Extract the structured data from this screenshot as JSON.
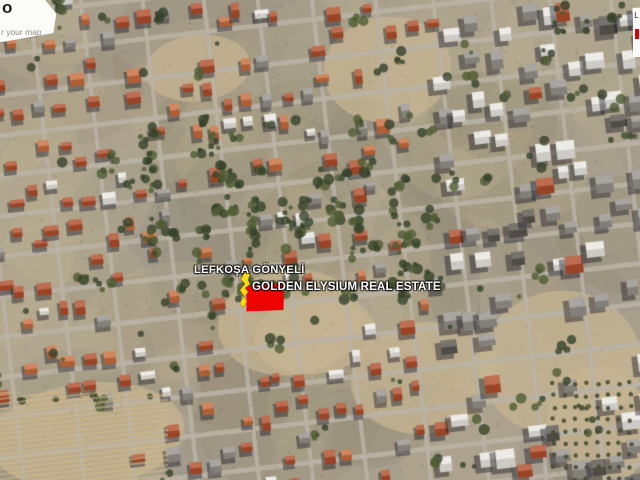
{
  "map_labels": {
    "region": "LEFKOŞA GÖNYELİ",
    "listing": "GOLDEN ELYSIUM REAL ESTATE"
  },
  "marker": {
    "color": "#f4dd16",
    "outline": "#b8860b"
  },
  "plot": {
    "fill": "#ee0202"
  },
  "watermark": {
    "logo_glyph": "o",
    "caption": "r your map"
  },
  "edge_panel": {
    "letter": "L",
    "accent_color": "#dd0000"
  },
  "palette": {
    "base": "#a69d8d",
    "road": "#bab2a4",
    "dirt": "#c6b491",
    "olive": "#8c8668",
    "roof_orange": "#b04e2b",
    "roof_orange2": "#c96c3c",
    "building_white": "#e9e7e1",
    "building_gray": "#96928b",
    "building_dark": "#5a564f",
    "shadow": "rgba(18,20,30,0.42)",
    "tree": "#35422a",
    "tree_light": "#4f5c33"
  }
}
